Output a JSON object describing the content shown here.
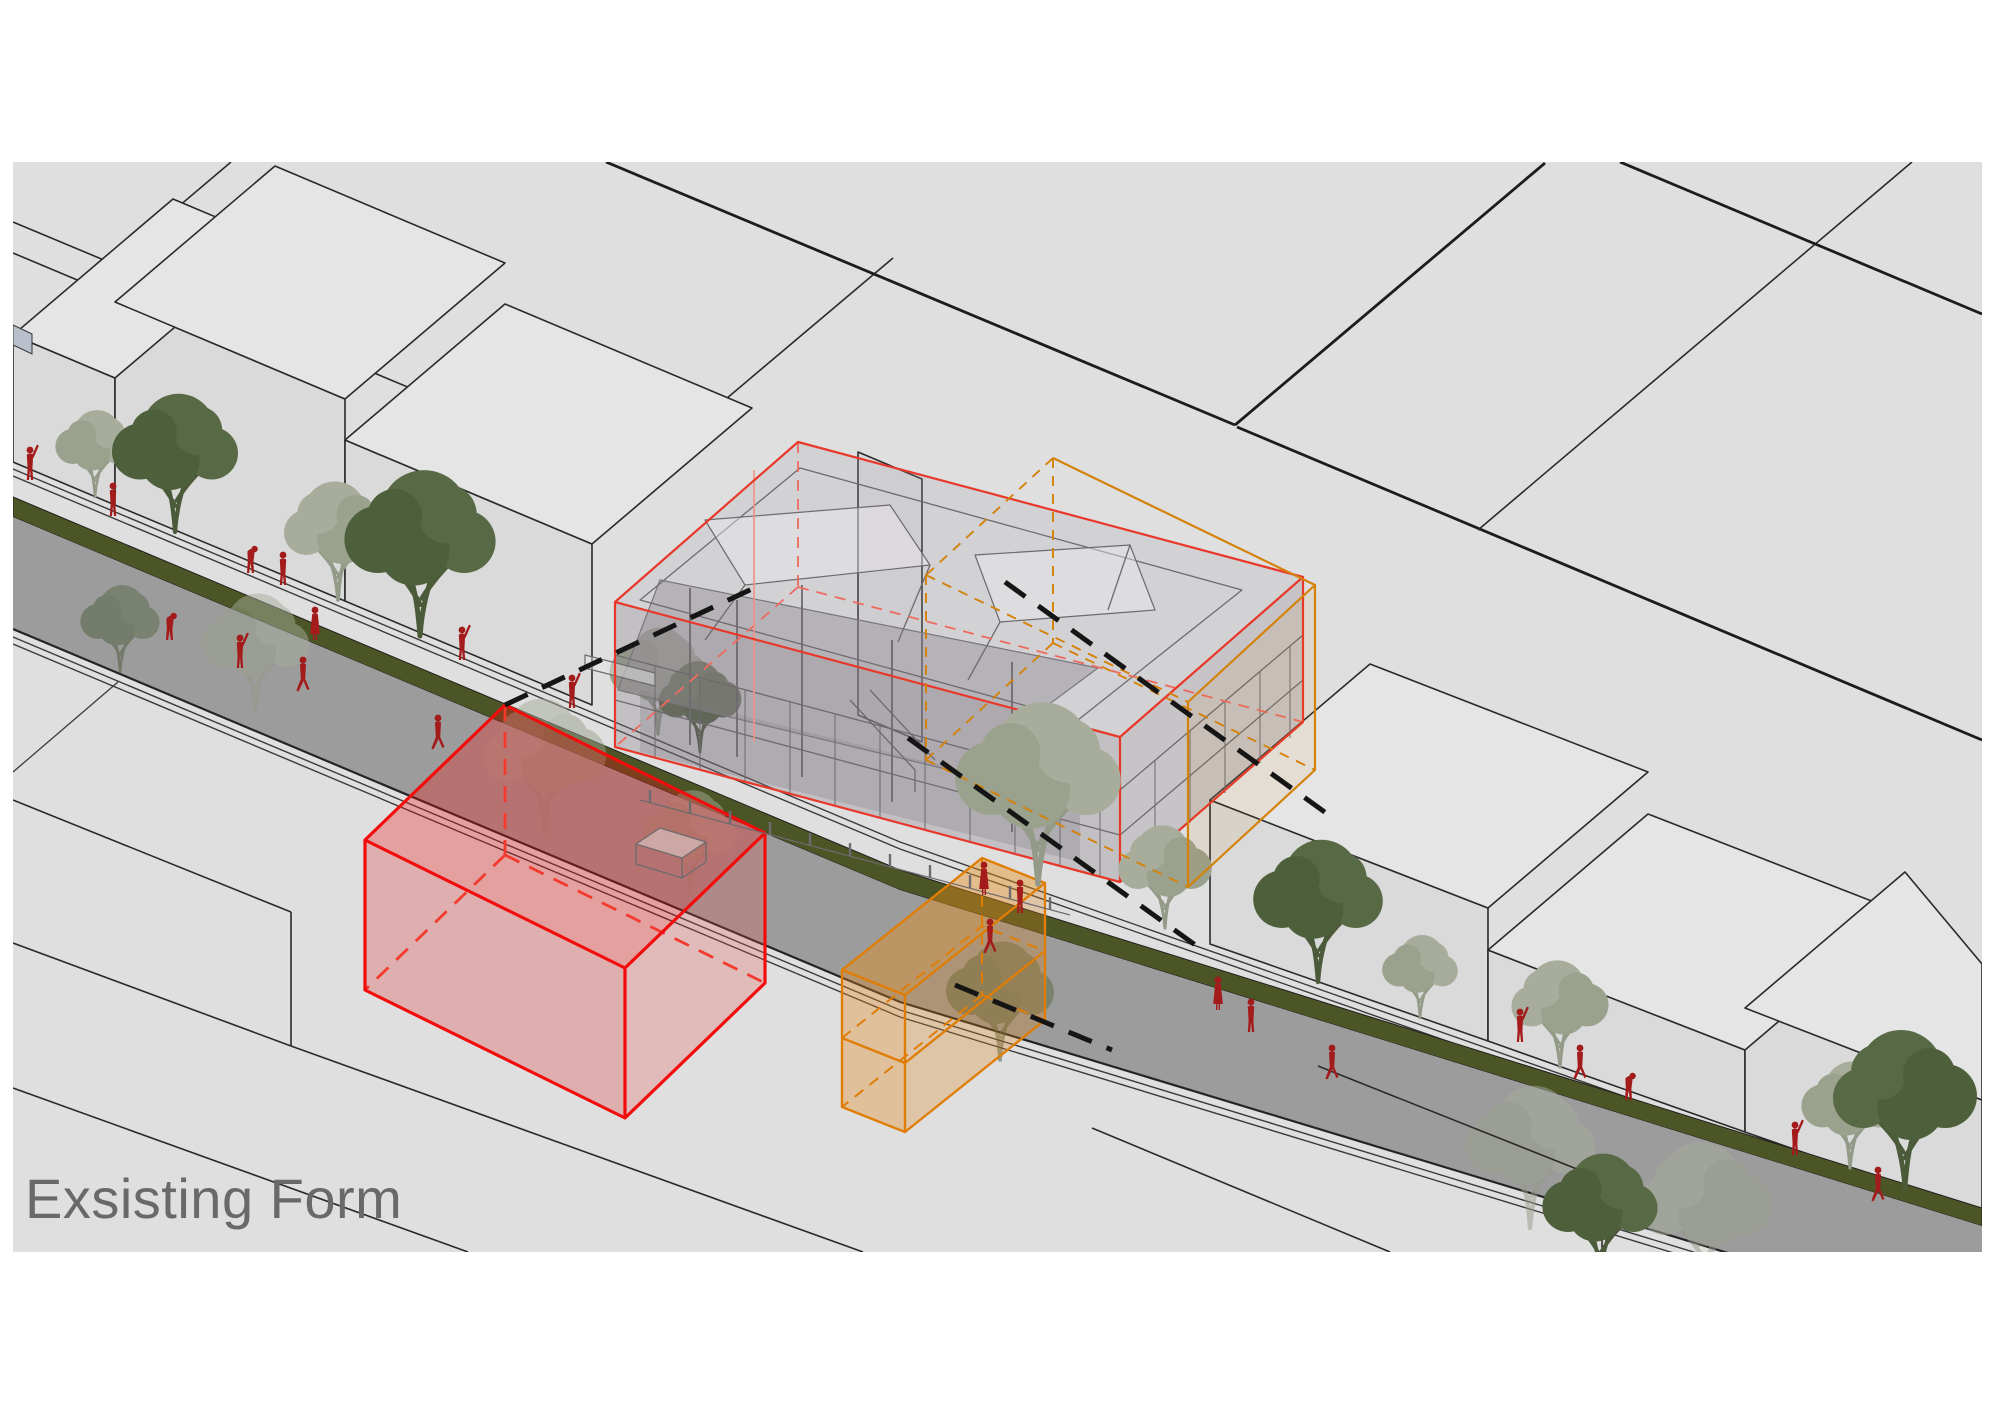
{
  "title": {
    "label": "Exsisting Form"
  },
  "diagram": {
    "type": "axonometric-urban-massing-diagram",
    "description_elements": {
      "red_massing_box": "translucent red box with dashed hidden edges on near block",
      "orange_massing_box": "translucent orange two-storey box beside red box",
      "building_model": "translucent grey wireframe building wrapped in thin red envelope box",
      "ghost_orange_box": "dashed orange envelope box on far side of building model",
      "leader_lines": "black dashed projection lines linking model corners to massing boxes",
      "street": "diagonal street with planted median, grey roadway, trees and pedestrians"
    },
    "colors": {
      "canvas": "#dfdfdf",
      "massing_red": "#f20d0d",
      "massing_orange": "#e07d05",
      "envelope_red": "#e8382a",
      "median_green": "#4c5526",
      "road_grey": "#9c9c9c",
      "tree_dark": "#586945",
      "tree_pale": "#a7ac9b",
      "pedestrian_red": "#a31b1b",
      "title_grey": "#696969"
    }
  }
}
